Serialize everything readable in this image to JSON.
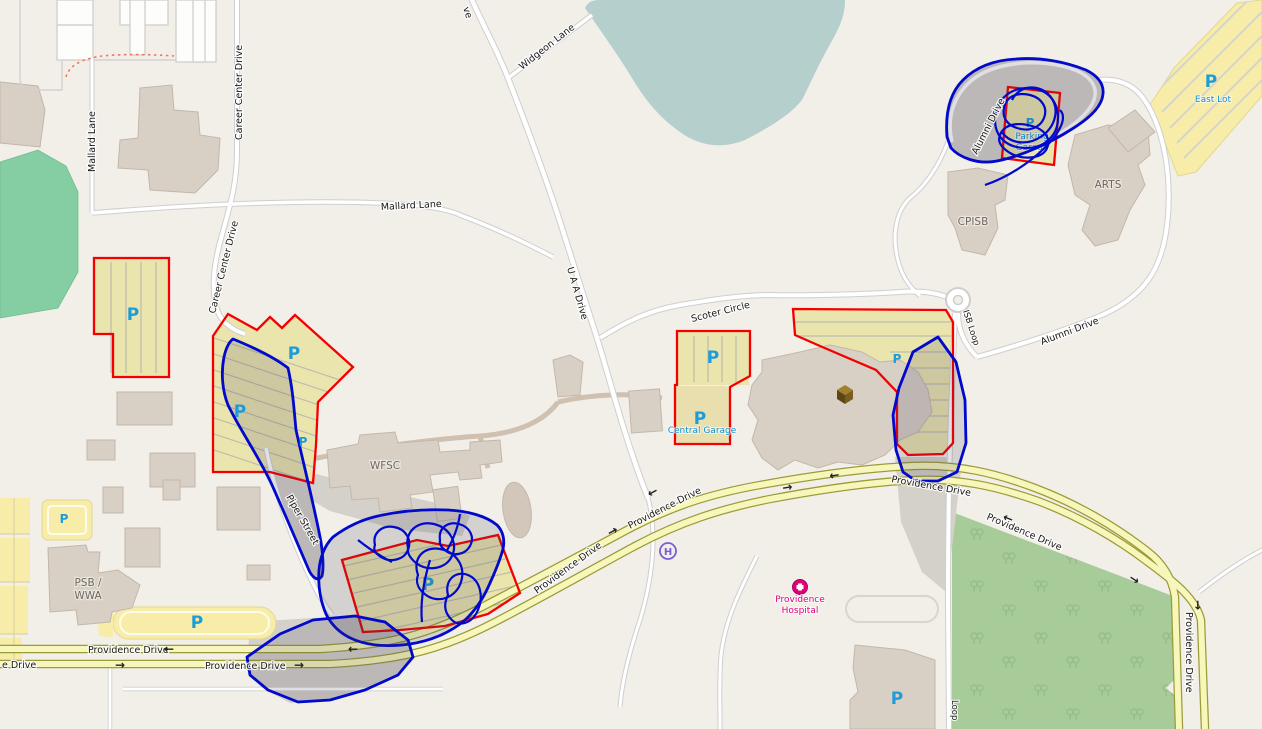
{
  "symbols": {
    "parking": "P",
    "helipad": "H",
    "arrow_left": "←",
    "arrow_right": "→"
  },
  "roads": {
    "career_center_drive": "Career Center Drive",
    "mallard_lane": "Mallard Lane",
    "widgeon_lane": "Widgeon Lane",
    "uaa_drive": "U A A Drive",
    "uaa_drive_partial": "ve",
    "scoter_circle": "Scoter Circle",
    "isb_loop": "ISB Loop",
    "isb_loop_partial": "Loop",
    "alumni_drive": "Alumni Drive",
    "piper_street": "Piper Street",
    "providence_drive": "Providence Drive",
    "providence_drive_partial": "e Drive"
  },
  "buildings": {
    "wfsc": "WFSC",
    "arts": "ARTS",
    "cpisb": "CPISB",
    "psb_wwa_line1": "PSB /",
    "psb_wwa_line2": "WWA"
  },
  "places": {
    "central_garage": "Central Garage",
    "parking_garage_line1": "Parking",
    "parking_garage_line2": "Garage",
    "east_lot": "East Lot",
    "hospital_line1": "Providence",
    "hospital_line2": "Hospital"
  },
  "colors": {
    "overlay_red": "#f50000",
    "overlay_blue": "#0009cc",
    "parking_p_blue": "#1e9cd7",
    "hospital_pink": "#e0007a",
    "helipad_purple": "#7b5ed1",
    "road_yellow": "#f7f7bb",
    "water": "#b5cfcc",
    "field_green": "#85cda2",
    "forest_green": "#a8cb9a",
    "parking_fill": "#eae4ad",
    "building_fill": "#d8cfc5"
  }
}
